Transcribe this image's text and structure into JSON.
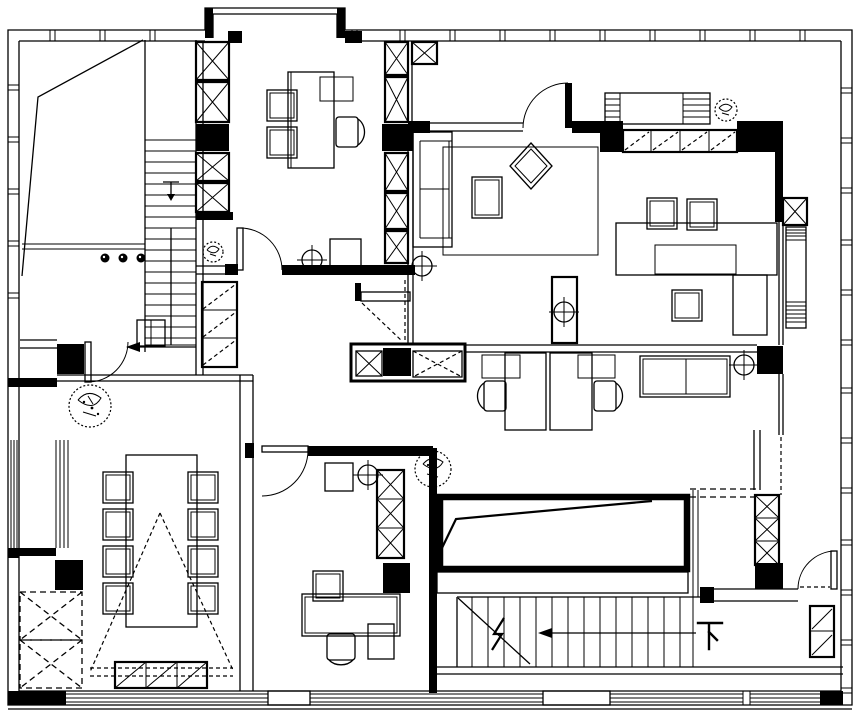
{
  "document": {
    "kind": "architectural floor plan, black ink line drawing",
    "paper_color": "#ffffff",
    "ink_color": "#000000"
  },
  "labels": {
    "stair_down": "下"
  },
  "inventory": {
    "rooms": [
      "north-private-office",
      "living-lounge",
      "east-study-corner",
      "open-plan-office",
      "meeting-room",
      "south-office",
      "entry-hall",
      "stair-hall",
      "east-balcony-corridor",
      "north-bay-window",
      "southeast-room"
    ],
    "stairs": [
      {
        "name": "upper-staircase",
        "direction_mark": "arrow-left"
      },
      {
        "name": "lower-staircase",
        "direction_mark": "arrow-left",
        "label": "下"
      }
    ],
    "furniture": [
      "executive-desk",
      "guest-chairs-x2",
      "office-chair",
      "sofa",
      "rug",
      "coffee-table",
      "decor-diamond-table",
      "dining-table",
      "dining-chairs",
      "sideboard",
      "bench",
      "meeting-table",
      "meeting-chairs-x8",
      "credenza",
      "paired-workstations",
      "work-desk",
      "monitor",
      "desk-chair",
      "mobile-pedestal",
      "x-hatch-storage-cabinets",
      "slash-hatch-wardrobes",
      "dashed-storage-boxes"
    ],
    "symbols": [
      "circle-cross-survey-marks-x5",
      "plants-x4",
      "solid-black-structural-columns",
      "window-mullion-ticks",
      "door-swing-arcs",
      "stair-break-line",
      "projection-dashed-cone",
      "ramp-void-with-slope-line"
    ]
  }
}
